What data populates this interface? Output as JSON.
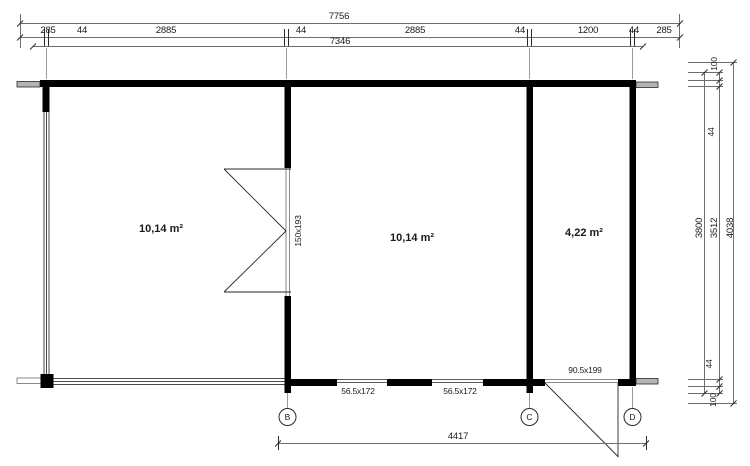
{
  "dims": {
    "top": {
      "overall": "7756",
      "inner": "7346",
      "segments": [
        "285",
        "44",
        "2885",
        "44",
        "2885",
        "44",
        "1200",
        "44",
        "285"
      ]
    },
    "right": {
      "overall_height": "4038",
      "outer_height": "3800",
      "interior_height": "3512",
      "overhang_top": "100",
      "wall_top": "44",
      "wall_bottom": "44",
      "overhang_bottom": "100"
    },
    "bottom": {
      "span": "4417"
    }
  },
  "rooms": [
    {
      "area": "10,14 m²"
    },
    {
      "area": "10,14 m²"
    },
    {
      "area": "4,22 m²"
    }
  ],
  "openings": {
    "double_door": "150x193",
    "window_left": "56.5x172",
    "window_right": "56.5x172",
    "entry_door": "90.5x199"
  },
  "grid": {
    "axis_b": "B",
    "axis_c": "C",
    "axis_d": "D"
  },
  "colors": {
    "wall": "#000000",
    "dim_line": "#6e6e6e",
    "thin_line": "#4a4a4a",
    "text": "#1a1a1a",
    "log_end_fill": "#b4b4b4",
    "background": "#ffffff"
  }
}
